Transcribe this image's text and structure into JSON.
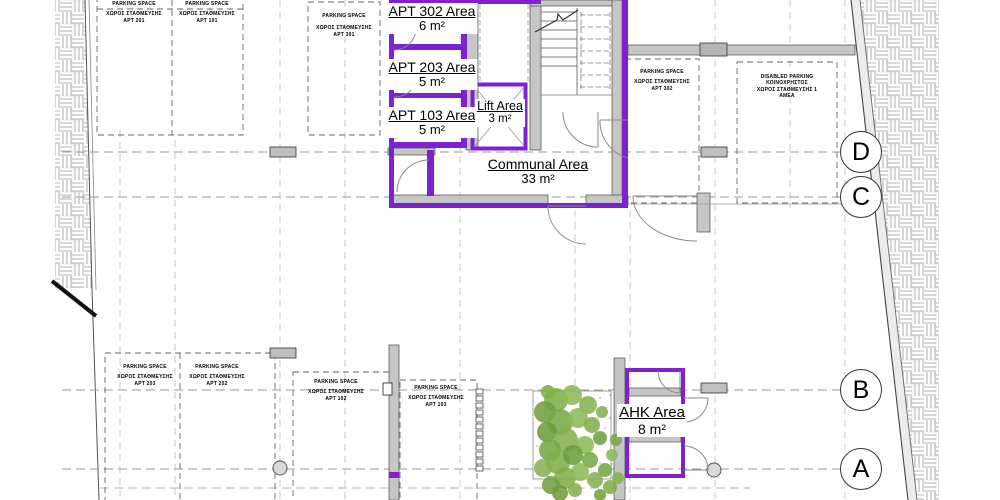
{
  "plan": {
    "rooms": {
      "apt302": {
        "title": "APT 302 Area",
        "area": "6 m²"
      },
      "apt203": {
        "title": "APT 203 Area",
        "area": "5 m²"
      },
      "apt103": {
        "title": "APT 103 Area",
        "area": "5 m²"
      },
      "lift": {
        "title": "Lift Area",
        "area": "3 m²"
      },
      "communal": {
        "title": "Communal Area",
        "area": "33 m²"
      },
      "ahk": {
        "title": "AHK Area",
        "area": "8 m²"
      }
    },
    "parking_label": "PARKING SPACE",
    "parking_greek": "ΧΩΡΟΣ ΣΤΑΘΜΕΥΣΗΣ",
    "parking_spaces": [
      {
        "apt": "APT 201"
      },
      {
        "apt": "APT 101"
      },
      {
        "apt": "APT 301"
      },
      {
        "apt": "APT 302"
      },
      {
        "apt": "APT 203"
      },
      {
        "apt": "APT 202"
      },
      {
        "apt": "APT 102"
      },
      {
        "apt": "APT 103"
      }
    ],
    "disabled_parking": {
      "line1": "DISABLED PARKING",
      "line2": "ΚΟΙΝΟΧΡΗΣΤΟΣ",
      "line3": "ΧΩΡΟΣ ΣΤΑΘΜΕΥΣΗΣ 1",
      "line4": "ΑΜΕΑ"
    },
    "grid_bubbles": [
      {
        "label": "D"
      },
      {
        "label": "C"
      },
      {
        "label": "B"
      },
      {
        "label": "A"
      }
    ],
    "colors": {
      "highlight_purple": "#7d22cf",
      "wall_gray": "#c6c6c6",
      "tree_green": "#7fae4a"
    }
  }
}
